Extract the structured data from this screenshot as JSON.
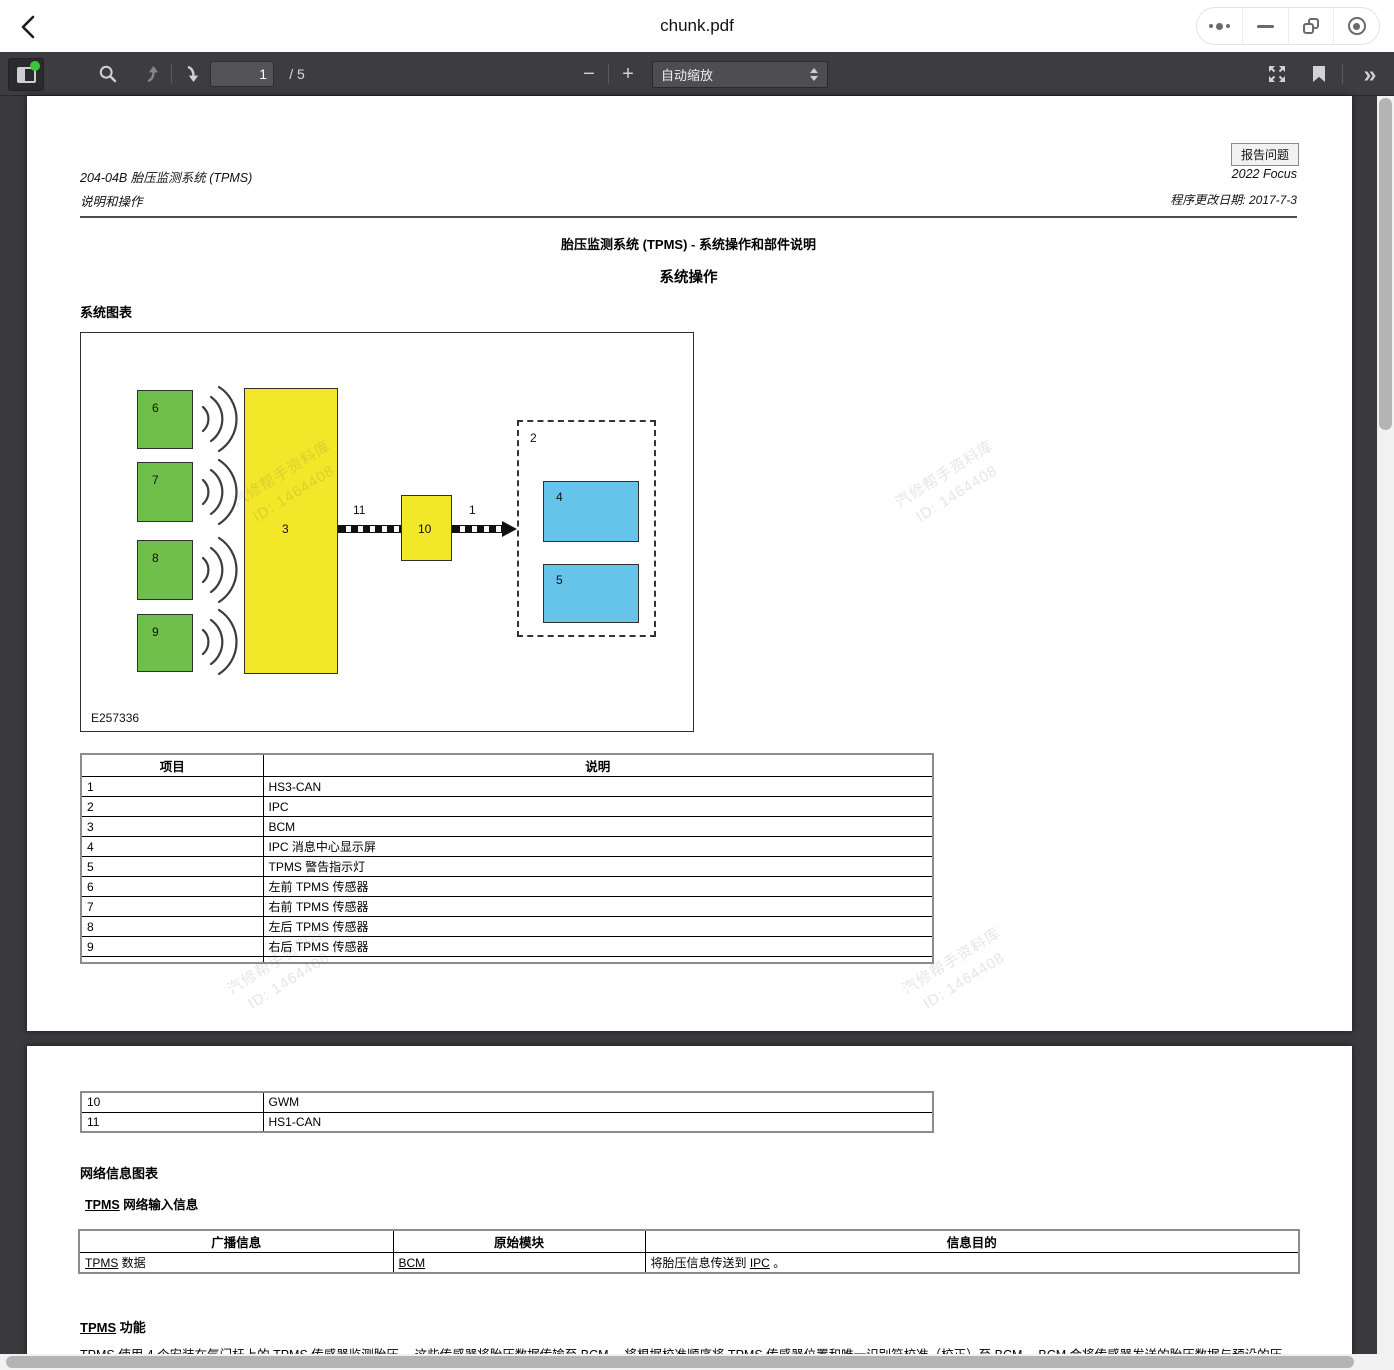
{
  "titlebar": {
    "title": "chunk.pdf"
  },
  "toolbar": {
    "page_input": "1",
    "page_total": "/ 5",
    "zoom_out": "−",
    "zoom_in": "+",
    "scale_mode": "自动缩放",
    "more_tools": "»"
  },
  "page1": {
    "doc_code": "204-04B 胎压监测系统 (TPMS)",
    "doc_sub": "说明和操作",
    "report_button": "报告问题",
    "model": "2022 Focus",
    "change_date": "程序更改日期: 2017-7-3",
    "title": "胎压监测系统 (TPMS) - 系统操作和部件说明",
    "subtitle": "系统操作",
    "section_heading": "系统图表",
    "diagram": {
      "code": "E257336",
      "labels": {
        "b6": "6",
        "b7": "7",
        "b8": "8",
        "b9": "9",
        "b3": "3",
        "b10": "10",
        "b2": "2",
        "b4": "4",
        "b5": "5",
        "l11": "11",
        "l1": "1"
      }
    },
    "table": {
      "headers": [
        "项目",
        "说明"
      ],
      "rows": [
        [
          "1",
          "HS3-CAN"
        ],
        [
          "2",
          "IPC"
        ],
        [
          "3",
          "BCM"
        ],
        [
          "4",
          "IPC 消息中心显示屏"
        ],
        [
          "5",
          "TPMS 警告指示灯"
        ],
        [
          "6",
          "左前 TPMS 传感器"
        ],
        [
          "7",
          "右前 TPMS 传感器"
        ],
        [
          "8",
          "左后 TPMS 传感器"
        ],
        [
          "9",
          "右后 TPMS 传感器"
        ]
      ]
    }
  },
  "page2": {
    "table_rows": [
      [
        "10",
        "GWM"
      ],
      [
        "11",
        "HS1-CAN"
      ]
    ],
    "network_heading": "网络信息图表",
    "network_sub_link": "TPMS",
    "network_sub_rest": " 网络输入信息",
    "msg_table": {
      "headers": [
        "广播信息",
        "原始模块",
        "信息目的"
      ],
      "row": {
        "col1_link": "TPMS",
        "col1_rest": " 数据",
        "col2_link": "BCM",
        "col3_pre": "将胎压信息传送到 ",
        "col3_link": "IPC",
        "col3_post": " 。"
      }
    },
    "func_heading_link": "TPMS",
    "func_heading_rest": " 功能",
    "paragraph": "TPMS 使用 4 个安装在气门杆上的 TPMS 传感器监测胎压。 这些传感器将胎压数据传输至 BCM。 将根据校准顺序将 TPMS 传感器位置和唯一识别符校准（校正）至 BCM。 BCM 会将传感器发送的胎压数据与预设的压"
  },
  "watermark": {
    "line1": "汽修帮手资料库",
    "line2": "ID: 1464408"
  },
  "colors": {
    "sensor_green": "#6fbf4a",
    "module_yellow": "#f3e72a",
    "display_blue": "#66c3e9",
    "toolbar_bg": "#3c3c41",
    "status_dot_green": "#3ec43e"
  }
}
